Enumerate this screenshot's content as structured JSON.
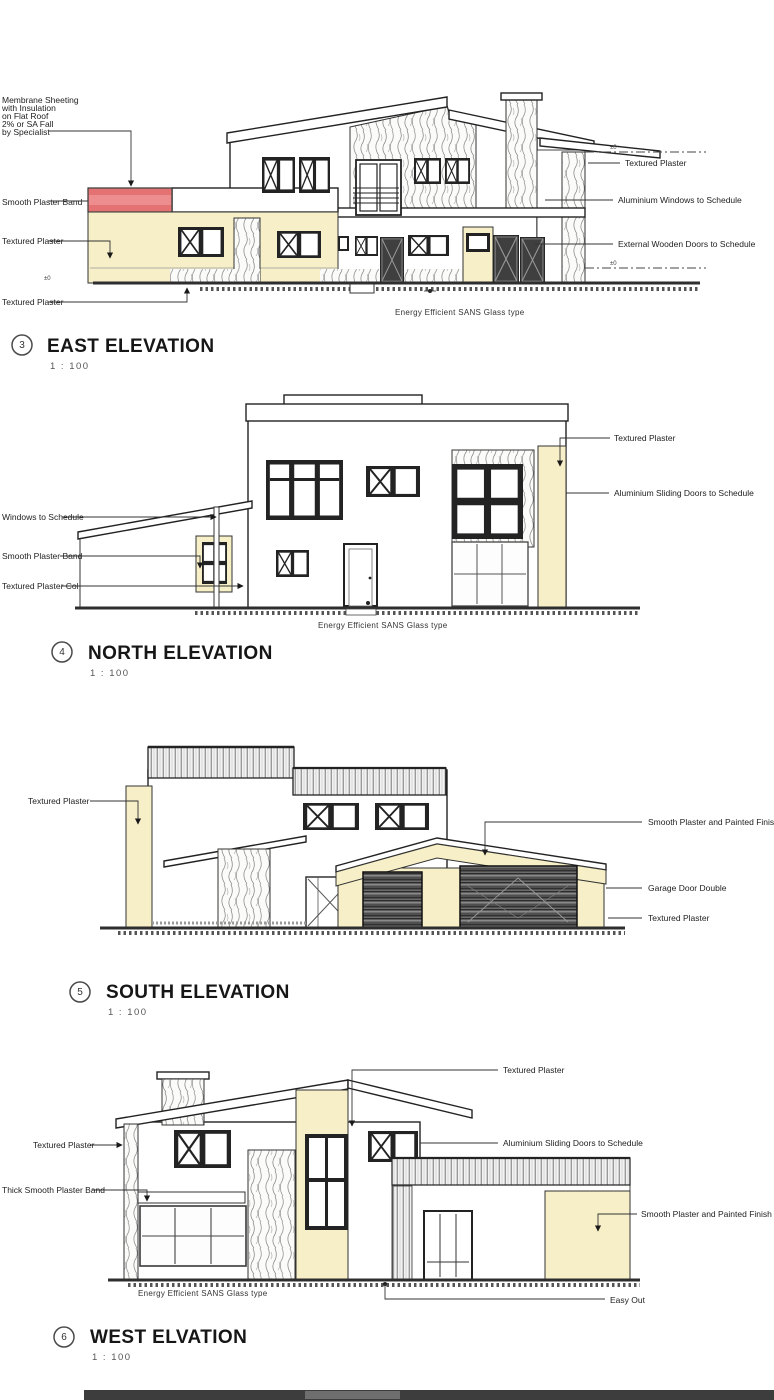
{
  "east": {
    "number": "3",
    "title": "EAST ELEVATION",
    "scale": "1 : 100",
    "roof_note": {
      "l1": "Membrane Sheeting",
      "l2": "with Insulation",
      "l3": "on Flat Roof",
      "l4": "2% or SA Fall",
      "l5": "by Specialist"
    },
    "labels": {
      "plaster_band": "Smooth Plaster Band",
      "textured_left": "Textured Plaster",
      "textured_base": "Textured Plaster",
      "textured_right": "Textured Plaster",
      "alu_windows": "Aluminium Windows to Schedule",
      "wood_doors": "External Wooden Doors to Schedule",
      "glass_note": "Energy Efficient SANS Glass type",
      "level_left": "±0",
      "level_r1": "±0",
      "level_r2": "±0"
    }
  },
  "north": {
    "number": "4",
    "title": "NORTH ELEVATION",
    "scale": "1 : 100",
    "labels": {
      "windows_schedule": "Windows to Schedule",
      "plaster_band": "Smooth Plaster Band",
      "textured_col": "Textured Plaster Col",
      "textured_right": "Textured Plaster",
      "alu_doors": "Aluminium Sliding Doors to Schedule",
      "glass_note": "Energy Efficient SANS Glass type"
    }
  },
  "south": {
    "number": "5",
    "title": "SOUTH ELEVATION",
    "scale": "1 : 100",
    "labels": {
      "textured_left": "Textured Plaster",
      "smooth_painted": "Smooth Plaster and Painted Finish",
      "garage_door": "Garage Door Double",
      "textured_right": "Textured Plaster"
    }
  },
  "west": {
    "number": "6",
    "title": "WEST ELVATION",
    "scale": "1 : 100",
    "labels": {
      "textured_top": "Textured Plaster",
      "alu_doors": "Aluminium Sliding Doors to Schedule",
      "smooth_painted": "Smooth Plaster and Painted Finish",
      "textured_left": "Textured Plaster",
      "thick_band": "Thick Smooth Plaster Band",
      "glass_note": "Energy Efficient SANS Glass type",
      "easy_out": "Easy Out"
    }
  }
}
